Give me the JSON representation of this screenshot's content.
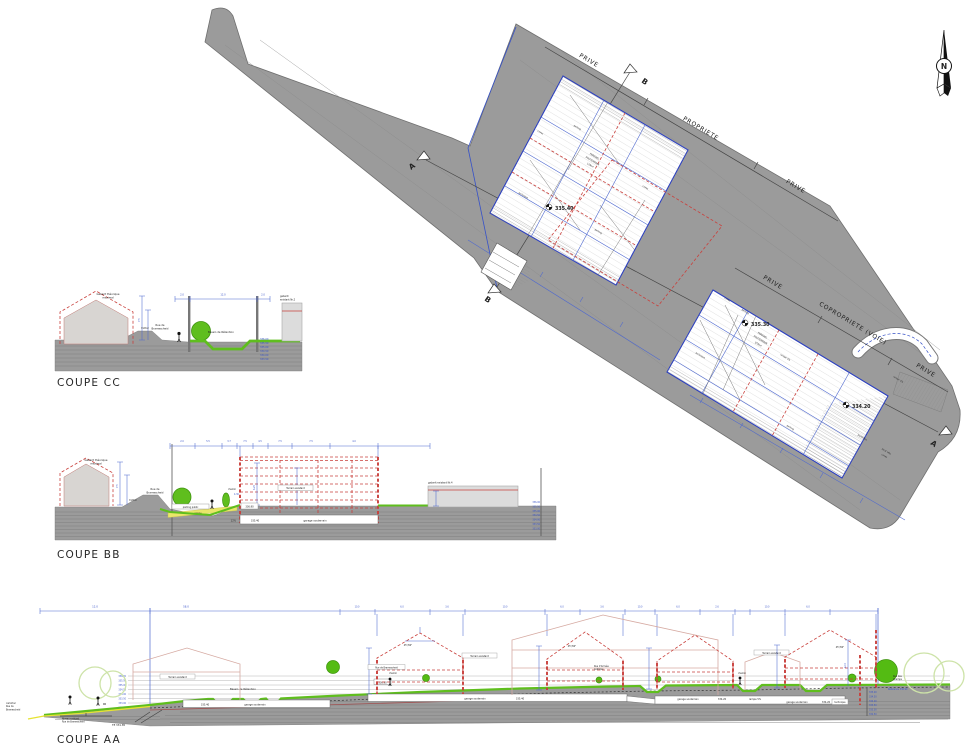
{
  "plan": {
    "north": "N",
    "bnd": [
      "PRIVE",
      "PROPRIETE",
      "PRIVE",
      "PRIVE",
      "COPROPRIETE (VOIE)",
      "PRIVE"
    ],
    "mk": {
      "a": "A",
      "b": "B"
    },
    "b1": {
      "t1": "PARKING",
      "t2": "SOUTERRAIN",
      "t3": "119m²",
      "elev": "335.40",
      "p": "parking",
      "c": "caves",
      "tech": "technique"
    },
    "b2": {
      "t1": "PARKING",
      "t2": "SOUTERRAIN",
      "t3": "978m²",
      "e1": "335.30",
      "e2": "334.20",
      "r": "rampe 5%",
      "p": "parking",
      "c": "caves",
      "tech": "technique",
      "pb": "poubelles",
      "lv1": "local vélo",
      "lv2": "caves"
    }
  },
  "cc": {
    "title": "COUPE CC",
    "g1": "Gabarit théorique",
    "g2": "maximal",
    "r1": "Rue de",
    "r2": "Bramescheid",
    "tr": "trottoir",
    "ba": "Bassin de Rétention",
    "ge1": "gabarit",
    "ge2": "existant Nr.2",
    "el": [
      "336.00",
      "335.50",
      "335.00",
      "334.50",
      "334.00",
      "333.50"
    ],
    "d": [
      "2.0",
      "12.0",
      "2.0"
    ],
    "dh": "7.5"
  },
  "bb": {
    "title": "COUPE BB",
    "g1": "Gabarit théorique",
    "g2": "maximal",
    "r1": "Rue de",
    "r2": "Bramescheid",
    "tr": "trottoir",
    "ch": "chemin",
    "pp": "parking public",
    "ra": "rampe",
    "pct": "12%",
    "gs": "garage souterrain",
    "te": "Terrain existant",
    "ge": "gabarit existant Nr.4",
    "v1": "336.90",
    "v2": "335.40",
    "dh1": "6.25",
    "dh2": "4.30",
    "dh3": "7.5",
    "el": [
      "336.00",
      "335.50",
      "335.00",
      "334.50",
      "334.00",
      "333.50",
      "333.00"
    ],
    "d": [
      "2.0",
      "5.5",
      "3.7",
      "7.5",
      "4.5",
      "7.5",
      "7.5",
      "4.0"
    ]
  },
  "aa": {
    "title": "COUPE AA",
    "dt": "58.0",
    "dl": "12.0",
    "d": [
      "10.0",
      "6.0",
      "3.6",
      "10.0",
      "6.0",
      "3.6",
      "10.0",
      "6.0",
      "2.6",
      "10.0",
      "6.0"
    ],
    "cf1": "carrefour",
    "cf2": "Rue de",
    "cf3": "Bramescheid",
    "nv1": "Niveau existant",
    "nv2": "Rue de Bramescheid",
    "te": "TE 331.85",
    "ba": "Bassin de Rétention",
    "tx": "Terrain existant",
    "ru1": "Rue de Bramescheid",
    "ch": "chemin",
    "ar1": "Rue d'Arrivée",
    "ar2": "publique",
    "rc1": "Rue des",
    "rc2": "Champs",
    "ref": "Référence 336.90",
    "ngd": "336.90",
    "gs": "garage souterrain",
    "v1": "335.40",
    "v2": "335.40",
    "v3": "334.20",
    "ra": "rampe 5%",
    "tech": "technique",
    "ang": "45°/60°",
    "dv": "12.5",
    "el": [
      "336.00",
      "335.50",
      "335.00",
      "334.50",
      "334.00",
      "333.50",
      "333.00",
      "332.50",
      "332.00"
    ],
    "er": [
      "335.00",
      "334.50",
      "334.00",
      "333.50",
      "333.00",
      "332.50"
    ]
  }
}
